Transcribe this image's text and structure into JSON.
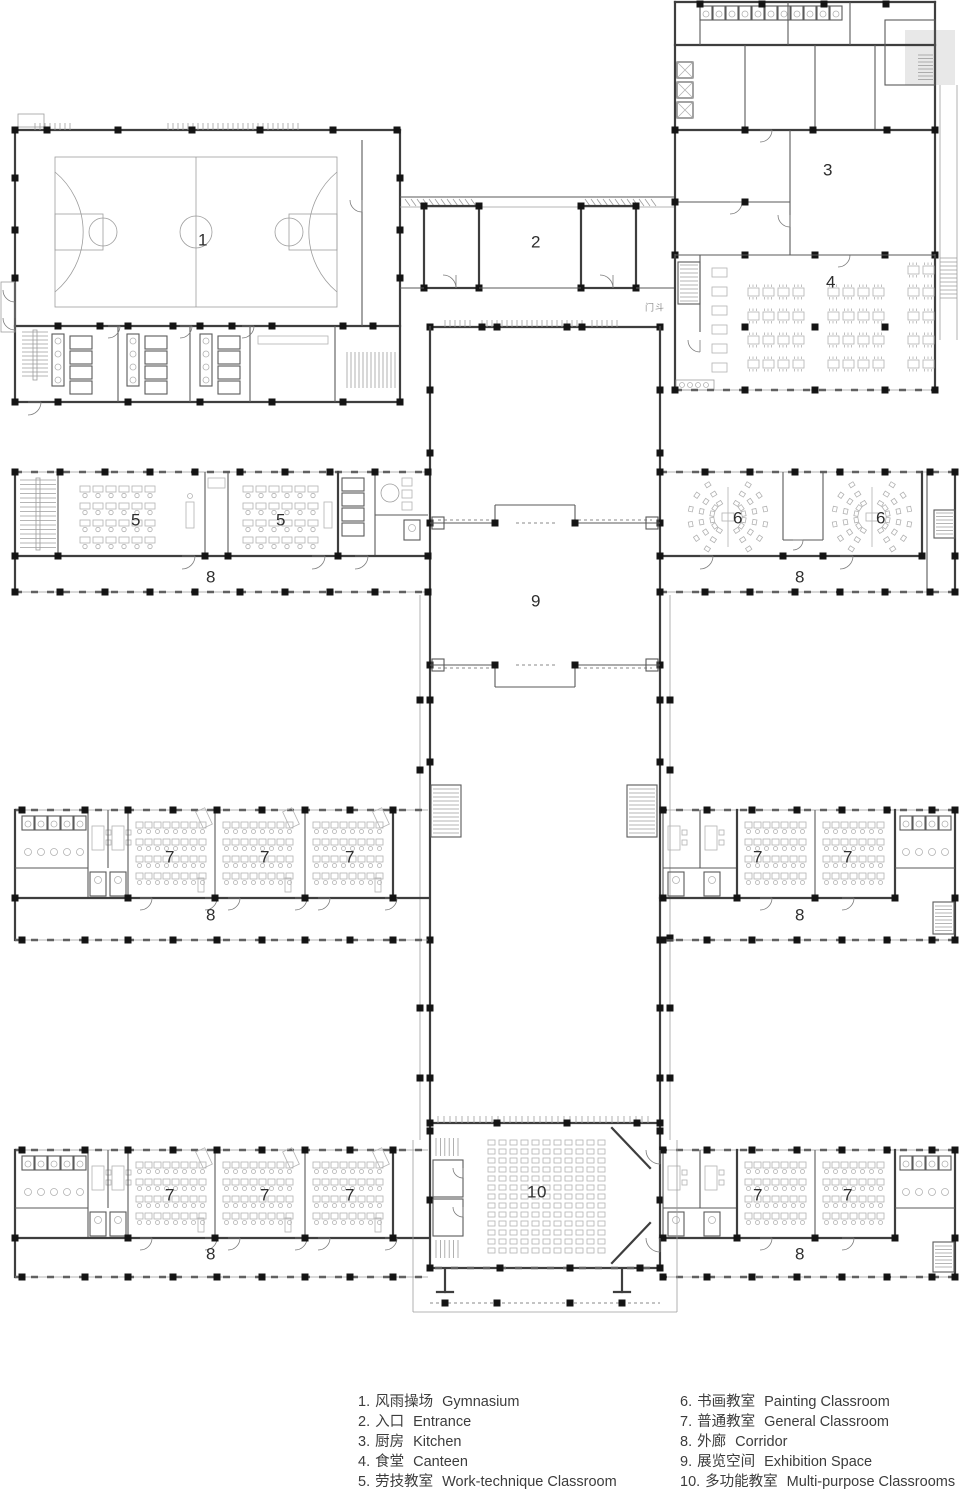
{
  "plan": {
    "room_labels": [
      {
        "room": "gymnasium",
        "text": "1",
        "x": 203,
        "y": 241
      },
      {
        "room": "entrance",
        "text": "2",
        "x": 536,
        "y": 243
      },
      {
        "room": "kitchen",
        "text": "3",
        "x": 828,
        "y": 171
      },
      {
        "room": "canteen",
        "text": "4",
        "x": 831,
        "y": 283
      },
      {
        "room": "work-technique-classroom-1",
        "text": "5",
        "x": 136,
        "y": 521
      },
      {
        "room": "work-technique-classroom-2",
        "text": "5",
        "x": 281,
        "y": 521
      },
      {
        "room": "painting-classroom-1",
        "text": "6",
        "x": 738,
        "y": 519
      },
      {
        "room": "painting-classroom-2",
        "text": "6",
        "x": 881,
        "y": 519
      },
      {
        "room": "corridor-mid-left",
        "text": "8",
        "x": 211,
        "y": 578
      },
      {
        "room": "corridor-mid-right",
        "text": "8",
        "x": 800,
        "y": 578
      },
      {
        "room": "exhibition-space",
        "text": "9",
        "x": 536,
        "y": 602
      },
      {
        "room": "general-classroom-1",
        "text": "7",
        "x": 170,
        "y": 858
      },
      {
        "room": "general-classroom-2",
        "text": "7",
        "x": 265,
        "y": 858
      },
      {
        "room": "general-classroom-3",
        "text": "7",
        "x": 350,
        "y": 858
      },
      {
        "room": "general-classroom-4",
        "text": "7",
        "x": 758,
        "y": 858
      },
      {
        "room": "general-classroom-5",
        "text": "7",
        "x": 848,
        "y": 858
      },
      {
        "room": "corridor-lower-left",
        "text": "8",
        "x": 211,
        "y": 916
      },
      {
        "room": "corridor-lower-right",
        "text": "8",
        "x": 800,
        "y": 916
      },
      {
        "room": "general-classroom-6",
        "text": "7",
        "x": 170,
        "y": 1196
      },
      {
        "room": "general-classroom-7",
        "text": "7",
        "x": 265,
        "y": 1196
      },
      {
        "room": "general-classroom-8",
        "text": "7",
        "x": 350,
        "y": 1196
      },
      {
        "room": "general-classroom-9",
        "text": "7",
        "x": 758,
        "y": 1196
      },
      {
        "room": "general-classroom-10",
        "text": "7",
        "x": 848,
        "y": 1196
      },
      {
        "room": "corridor-bottom-left",
        "text": "8",
        "x": 211,
        "y": 1255
      },
      {
        "room": "corridor-bottom-right",
        "text": "8",
        "x": 800,
        "y": 1255
      },
      {
        "room": "multi-purpose-classroom",
        "text": "10",
        "x": 537,
        "y": 1193
      }
    ],
    "annotations": [
      {
        "name": "vestibule-note",
        "text": "门斗",
        "x": 655,
        "y": 307
      }
    ]
  },
  "legend": {
    "items": [
      {
        "num": "1.",
        "zh": "风雨操场",
        "en": "Gymnasium"
      },
      {
        "num": "2.",
        "zh": "入口",
        "en": "Entrance"
      },
      {
        "num": "3.",
        "zh": "厨房",
        "en": "Kitchen"
      },
      {
        "num": "4.",
        "zh": "食堂",
        "en": "Canteen"
      },
      {
        "num": "5.",
        "zh": "劳技教室",
        "en": "Work-technique Classroom"
      },
      {
        "num": "6.",
        "zh": "书画教室",
        "en": "Painting Classroom"
      },
      {
        "num": "7.",
        "zh": "普通教室",
        "en": "General Classroom"
      },
      {
        "num": "8.",
        "zh": "外廊",
        "en": "Corridor"
      },
      {
        "num": "9.",
        "zh": "展览空间",
        "en": "Exhibition Space"
      },
      {
        "num": "10.",
        "zh": "多功能教室",
        "en": "Multi-purpose Classrooms"
      }
    ]
  }
}
